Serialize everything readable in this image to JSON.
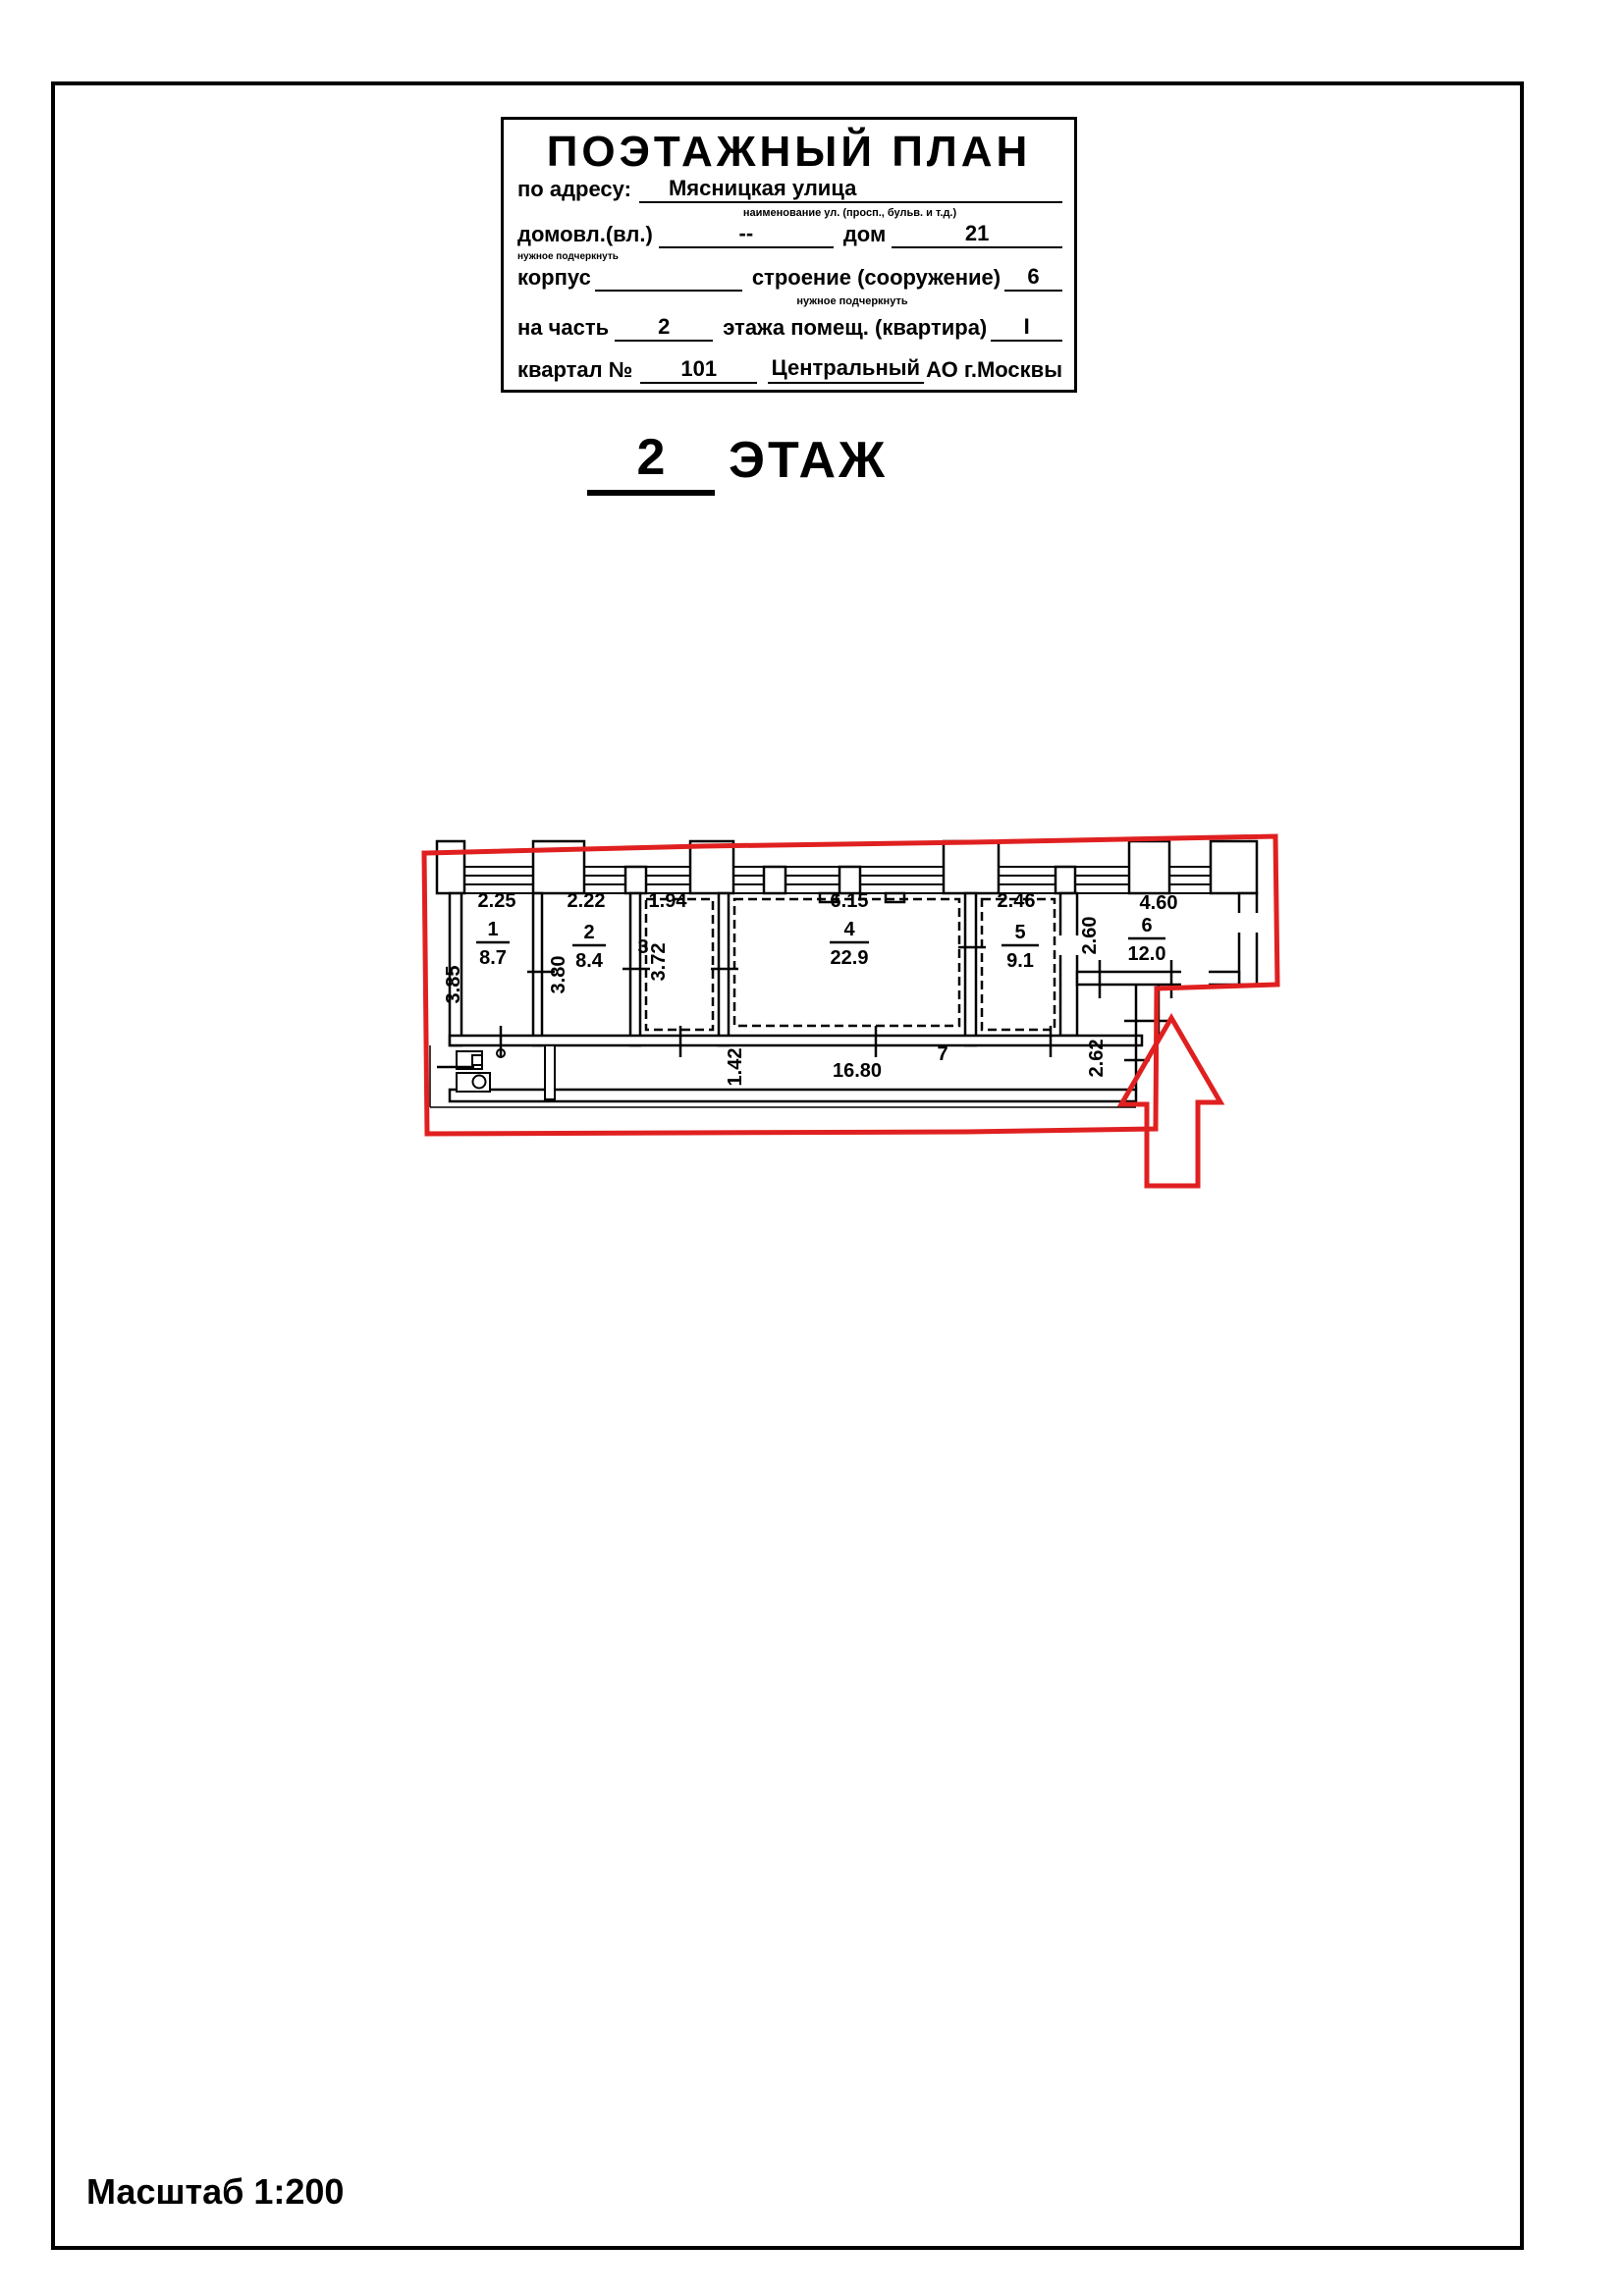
{
  "header": {
    "title": "ПОЭТАЖНЫЙ ПЛАН",
    "address_label": "по адресу:",
    "address_value": "Мясницкая улица",
    "address_note": "наименование ул. (просп., бульв. и т.д.)",
    "ownership_label": "домовл.(вл.)",
    "ownership_value": "--",
    "ownership_note": "нужное подчеркнуть",
    "house_label": "дом",
    "house_value": "21",
    "korpus_label": "корпус",
    "stroenie_label": "строение (сооружение)",
    "stroenie_value": "6",
    "stroenie_note": "нужное подчеркнуть",
    "part_label": "на часть",
    "part_value": "2",
    "floor_part_label": "этажа помещ. (квартира)",
    "floor_part_value": "I",
    "kvartal_label": "квартал №",
    "kvartal_value": "101",
    "district_value": "Центральный",
    "district_suffix": "АО г.Москвы"
  },
  "floor_title": {
    "number": "2",
    "label": "ЭТАЖ"
  },
  "plan": {
    "rooms": [
      {
        "number": "1",
        "area": "8.7",
        "width": "2.25",
        "depth": "3.85"
      },
      {
        "number": "2",
        "area": "8.4",
        "width": "2.22",
        "depth": "3.80"
      },
      {
        "number": "3",
        "area": "",
        "width": "1.94",
        "depth": "3.72"
      },
      {
        "number": "4",
        "area": "22.9",
        "width": "6.15",
        "depth": ""
      },
      {
        "number": "5",
        "area": "9.1",
        "width": "2.46",
        "depth": ""
      },
      {
        "number": "6",
        "area": "12.0",
        "width": "4.60",
        "depth": "2.60"
      }
    ],
    "corridor": {
      "number": "7",
      "length": "16.80",
      "width": "1.42",
      "side": "2.62"
    }
  },
  "scale_label": "Масштаб 1:200"
}
